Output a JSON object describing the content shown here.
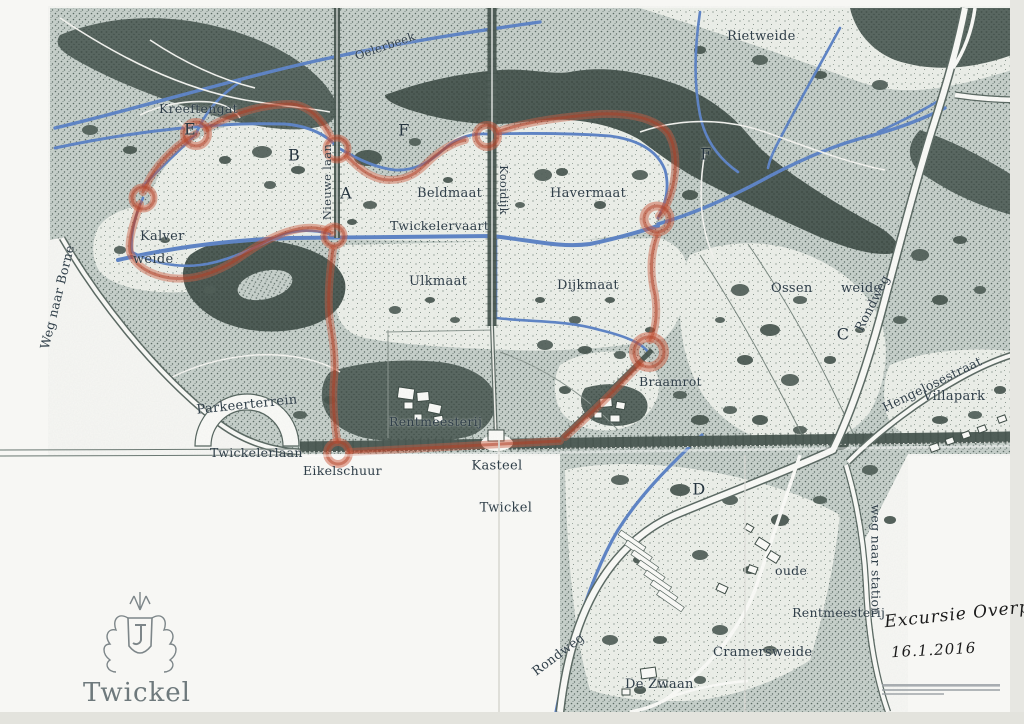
{
  "areas": {
    "rietweide": "Rietweide",
    "kreeftengat": "Kreeftengat",
    "beldmaat": "Beldmaat",
    "havermaat": "Havermaat",
    "ulkmaat": "Ulkmaat",
    "dijkmaat": "Dijkmaat",
    "kalverweide_line1": "Kalver",
    "kalverweide_line2": "weide",
    "ossenweide": "Ossen weide",
    "braamrot": "Braamrot",
    "cramersweide": "Cramersweide",
    "villapark": "Villapark"
  },
  "waterways": {
    "oelerbeek": "Oelerbeek",
    "twickelervaart": "Twickelervaart"
  },
  "roads": {
    "nieuwe_laan": "Nieuwe laan",
    "kooidijk": "Kooidijk",
    "twickelerlaan": "Twickelerlaan",
    "rondweg_ne": "Rondweg",
    "rondweg_s": "Rondweg",
    "hengelosestraat": "Hengelosestraat",
    "weg_naar_borne": "Weg naar Borne",
    "weg_naar_station": "weg naar station"
  },
  "places": {
    "parkeerterrein": "Parkeerterrein",
    "eikelschuur": "Eikelschuur",
    "rentmeesterij": "Rentmeesterij",
    "kasteel_line1": "Kasteel",
    "kasteel_line2": "Twickel",
    "oude_rm_line1": "oude",
    "oude_rm_line2": "Rentmeesterij",
    "de_zwaan": "De Zwaan"
  },
  "route_markers": {
    "a": "A",
    "b": "B",
    "c": "C",
    "d": "D",
    "e": "E",
    "f_north": "F",
    "f_east": "F"
  },
  "annotation": {
    "line1": "Excursie Overpark",
    "line2": "16.1.2016"
  },
  "logo": {
    "estate_name": "Twickel"
  },
  "colors": {
    "route_red": "#c0392b",
    "water_blue": "#5d83c6",
    "woods_dark": "#4f5e58",
    "meadow_light": "#eef1ec",
    "ink": "#2f3e48",
    "paper": "#f7f7f4"
  }
}
